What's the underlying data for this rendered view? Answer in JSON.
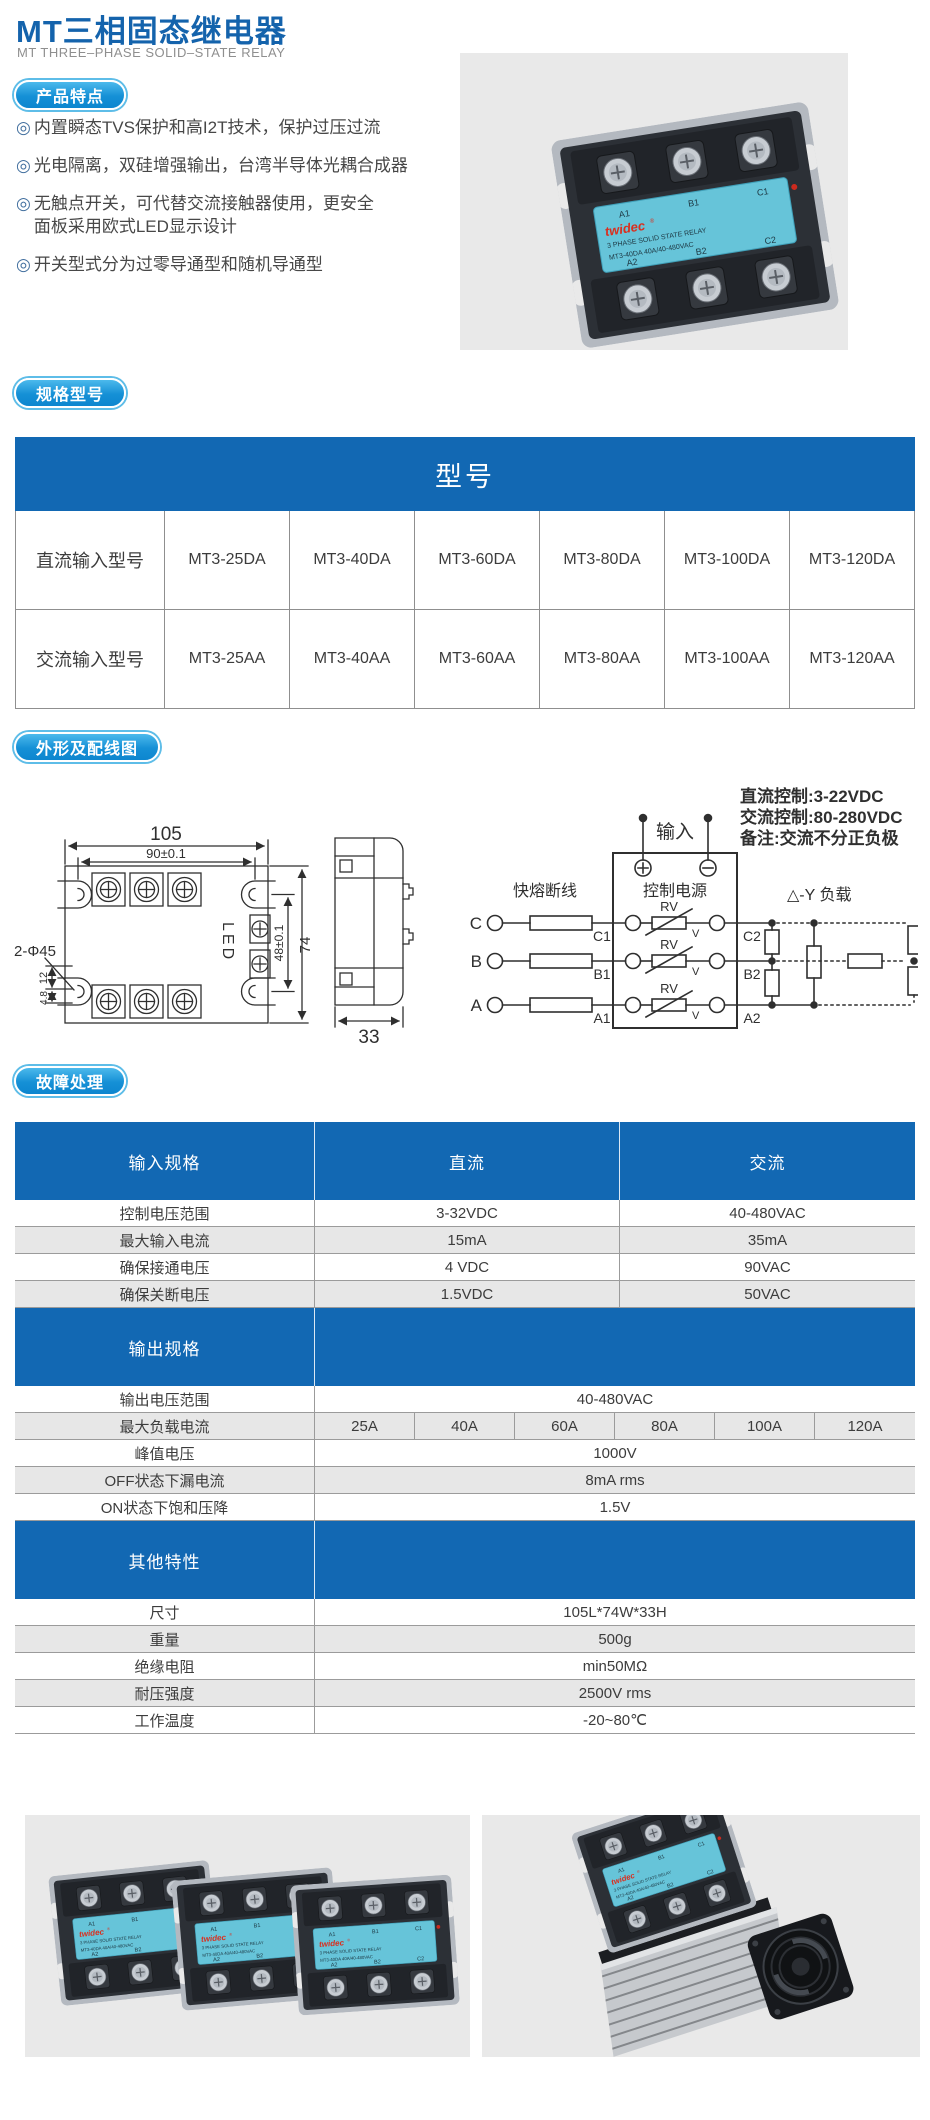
{
  "colors": {
    "primary_blue": "#1268b3",
    "title_blue": "#1463ac",
    "badge_blue": "#1590d6",
    "row_gray": "#e7e7e7",
    "photo_bg": "#e9e9e9",
    "relay_body": "#2c3036",
    "label_cyan": "#66c4d9",
    "brand_red": "#d92f1f"
  },
  "header": {
    "title": "MT三相固态继电器",
    "subtitle": "MT THREE–PHASE SOLID–STATE RELAY"
  },
  "badges": {
    "features": "产品特点",
    "models": "规格型号",
    "outline": "外形及配线图",
    "fault": "故障处理"
  },
  "features": {
    "marker": "◎",
    "b1": "内置瞬态TVS保护和高I2T技术，保护过压过流",
    "b2": "光电隔离，双硅增强输出，台湾半导体光耦合成器",
    "b3a": "无触点开关，可代替交流接触器使用，更安全",
    "b3b": "面板采用欧式LED显示设计",
    "b4": "开关型式分为过零导通型和随机导通型"
  },
  "hero_label": {
    "brand": "twidec",
    "reg": "®",
    "line1": "3 PHASE  SOLID STATE RELAY",
    "line2": "MT3-40DA    40A/40-480VAC",
    "t1": "A1",
    "t2": "B1",
    "t3": "C1",
    "u1": "A2",
    "u2": "B2",
    "u3": "C2"
  },
  "model_table": {
    "title": "型号",
    "row1_label": "直流输入型号",
    "row1": [
      "MT3-25DA",
      "MT3-40DA",
      "MT3-60DA",
      "MT3-80DA",
      "MT3-100DA",
      "MT3-120DA"
    ],
    "row2_label": "交流输入型号",
    "row2": [
      "MT3-25AA",
      "MT3-40AA",
      "MT3-60AA",
      "MT3-80AA",
      "MT3-100AA",
      "MT3-120AA"
    ]
  },
  "outline": {
    "dim_105": "105",
    "dim_90": "90±0.1",
    "dim_holes": "2-Φ45",
    "dim_12": "12",
    "dim_48s": "4.8",
    "led": "LED",
    "dim_48": "48±0.1",
    "dim_74": "74",
    "dim_33": "33"
  },
  "wiring": {
    "input": "输入",
    "note1": "直流控制:3-22VDC",
    "note2": "交流控制:80-280VDC",
    "note3": "备注:交流不分正负极",
    "fuse": "快熔断线",
    "control_power": "控制电源",
    "load": "△-Y 负载",
    "rv": "RV",
    "v": "V",
    "pC": "C",
    "pB": "B",
    "pA": "A",
    "tC1": "C1",
    "tB1": "B1",
    "tA1": "A1",
    "tC2": "C2",
    "tB2": "B2",
    "tA2": "A2"
  },
  "spec_table": {
    "s1": {
      "h1": "输入规格",
      "h2": "直流",
      "h3": "交流",
      "rows": [
        [
          "控制电压范围",
          "3-32VDC",
          "40-480VAC"
        ],
        [
          "最大输入电流",
          "15mA",
          "35mA"
        ],
        [
          "确保接通电压",
          "4 VDC",
          "90VAC"
        ],
        [
          "确保关断电压",
          "1.5VDC",
          "50VAC"
        ]
      ]
    },
    "s2": {
      "h1": "输出规格",
      "r1": [
        "输出电压范围",
        "40-480VAC"
      ],
      "r2_label": "最大负载电流",
      "r2": [
        "25A",
        "40A",
        "60A",
        "80A",
        "100A",
        "120A"
      ],
      "r3": [
        "峰值电压",
        "1000V"
      ],
      "r4": [
        "OFF状态下漏电流",
        "8mA rms"
      ],
      "r5": [
        "ON状态下饱和压降",
        "1.5V"
      ]
    },
    "s3": {
      "h1": "其他特性",
      "rows": [
        [
          "尺寸",
          "105L*74W*33H"
        ],
        [
          "重量",
          "500g"
        ],
        [
          "绝缘电阻",
          "min50MΩ"
        ],
        [
          "耐压强度",
          "2500V rms"
        ],
        [
          "工作温度",
          "-20~80℃"
        ]
      ]
    }
  }
}
